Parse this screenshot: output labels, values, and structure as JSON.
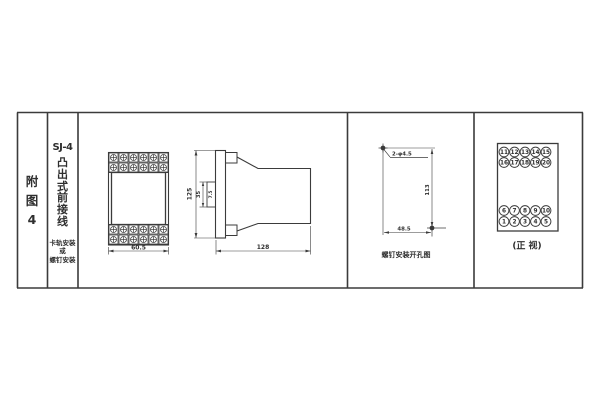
{
  "colors": {
    "line": "#3b3b3b",
    "text": "#2f2f2f",
    "background": "#ffffff"
  },
  "sidebar": {
    "figure_chars": [
      "附",
      "图",
      "4"
    ],
    "model": "SJ-4",
    "type_chars": [
      "凸",
      "出",
      "式",
      "前",
      "接",
      "线"
    ],
    "mount_lines": [
      "卡轨安装",
      "或",
      "螺钉安装"
    ]
  },
  "front_view": {
    "width_dim": "60.5"
  },
  "side_view": {
    "height_dim": "125",
    "rail_width_dim": "35",
    "rail_depth_dim": "7.5",
    "depth_dim": "128"
  },
  "drill_view": {
    "holes_label": "2-φ4.5",
    "height_dim": "113",
    "width_dim": "48.5",
    "caption": "螺钉安装开孔图"
  },
  "terminal_view": {
    "caption": "(正 视)",
    "rows": [
      [
        "11",
        "12",
        "13",
        "14",
        "15"
      ],
      [
        "16",
        "17",
        "18",
        "19",
        "20"
      ],
      [
        "6",
        "7",
        "8",
        "9",
        "10"
      ],
      [
        "1",
        "2",
        "3",
        "4",
        "5"
      ]
    ]
  }
}
